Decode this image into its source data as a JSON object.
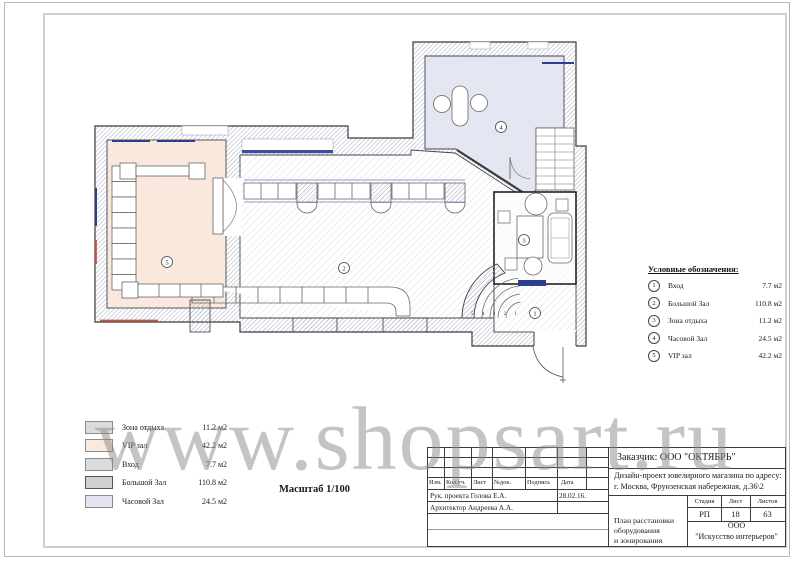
{
  "plan": {
    "zone_markers": [
      "1",
      "2",
      "3",
      "4",
      "5"
    ],
    "step_numbers": "5 4 3 2 1"
  },
  "colors": {
    "vip_zone": "#fbe9dd",
    "watch_zone": "#e4e6f2",
    "rest_zone": "#fdfdfd",
    "window_blue": "#2c3e8c",
    "bay_blue": "#3a4fa0",
    "radiator_red": "#c85a3a",
    "swatch_rest": "#dcdcdc",
    "swatch_vip": "#fbe9dd",
    "swatch_entry": "#dcdcdc",
    "swatch_hall": "#d0d0d4",
    "swatch_watch": "#e4e4f0"
  },
  "legend_right": {
    "title": "Условные обозначения:",
    "items": [
      {
        "num": "1",
        "name": "Вход",
        "area": "7.7 м2"
      },
      {
        "num": "2",
        "name": "Большой Зал",
        "area": "110.8 м2"
      },
      {
        "num": "3",
        "name": "Зона отдыха",
        "area": "11.2 м2"
      },
      {
        "num": "4",
        "name": "Часовой Зал",
        "area": "24.5 м2"
      },
      {
        "num": "5",
        "name": "VIP зал",
        "area": "42.2 м2"
      }
    ]
  },
  "legend_left": {
    "items": [
      {
        "name": "Зона отдыха",
        "area": "11.2 м2",
        "color": "#dcdcdc"
      },
      {
        "name": "VIP зал",
        "area": "42.2 м2",
        "color": "#fbe9dd"
      },
      {
        "name": "Вход",
        "area": "7.7 м2",
        "color": "#dcdcdc"
      },
      {
        "name": "Большой Зал",
        "area": "110.8 м2",
        "color": "#d0d0d4"
      },
      {
        "name": "Часовой Зал",
        "area": "24.5 м2",
        "color": "#e4e4f0"
      }
    ]
  },
  "scale_label": "Масштаб 1/100",
  "watermark": "www.shopsart.ru",
  "title_block": {
    "customer": "Заказчик:  ООО \"ОКТЯБРЬ\"",
    "address_line1": "Дизайн-проект ювелирного магазина по адресу:",
    "address_line2": "г. Москва, Фрунзенская набережная, д.36\\2",
    "rev_headers": [
      "Изм.",
      "Кол.уч.",
      "Лист",
      "№док.",
      "Подпись",
      "Дата"
    ],
    "row1_role_name": "Рук. проекта Голова Е.А.",
    "row1_date": "28.02.16.",
    "row2_role_name": "Архитектор  Андреева А.А.",
    "stage_headers": [
      "Стадия",
      "Лист",
      "Листов"
    ],
    "stage": "РП",
    "sheet_num": "18",
    "sheets_total": "63",
    "drawing_title_line1": "План расстановки оборудования",
    "drawing_title_line2": "и зонирования",
    "company_line1": "ООО",
    "company_line2": "\"Искусство интерьеров\""
  }
}
